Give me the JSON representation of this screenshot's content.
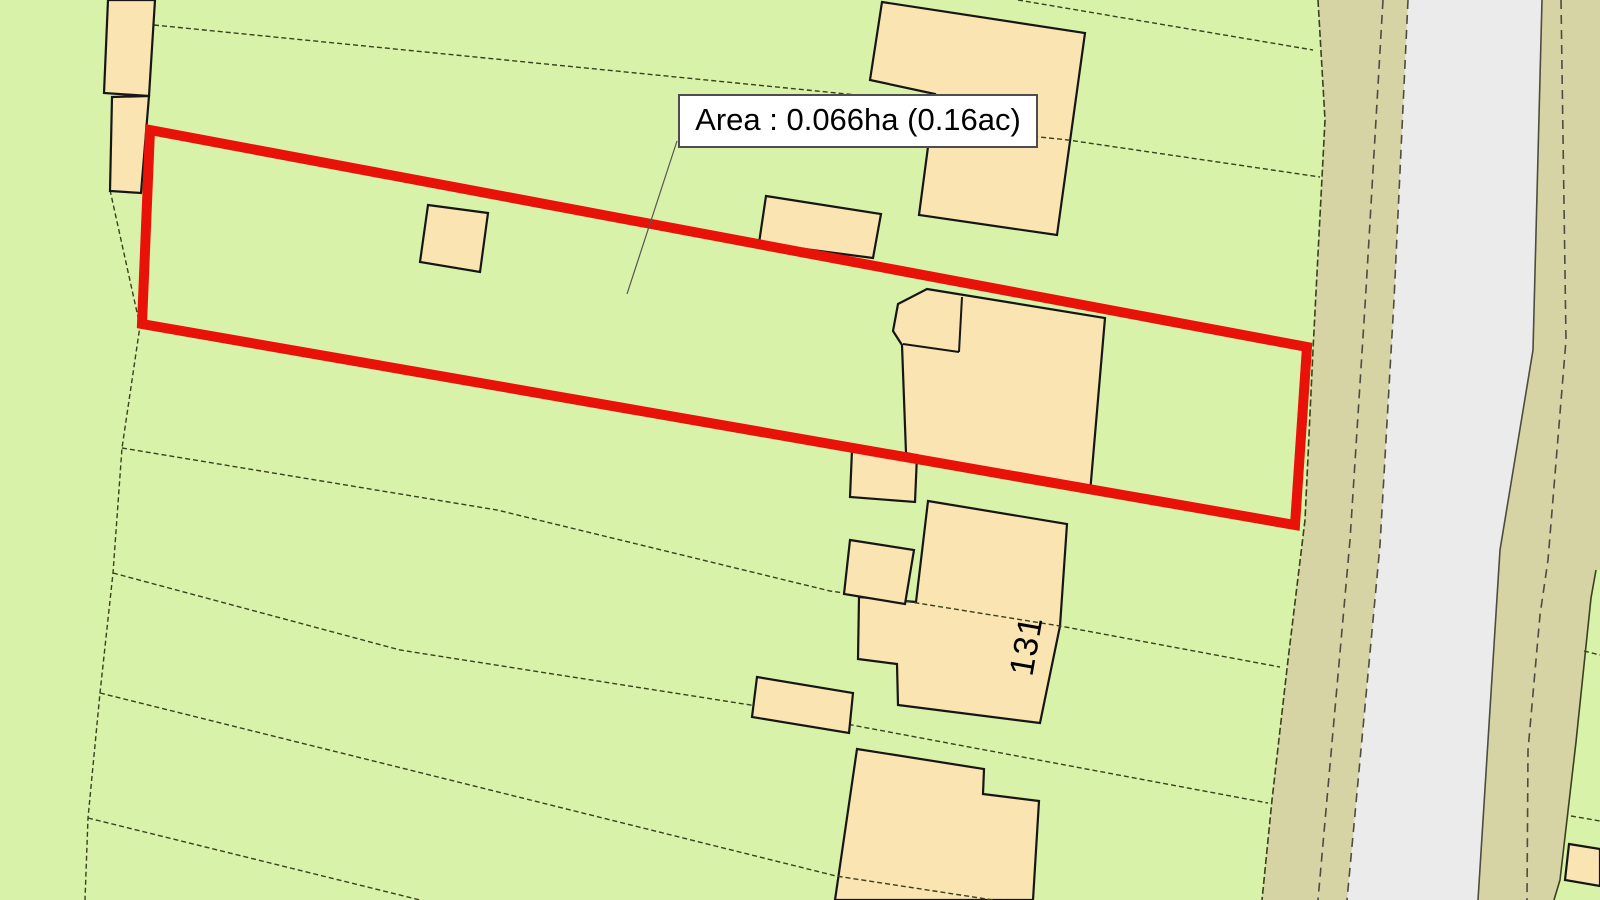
{
  "scene": {
    "width": 1600,
    "height": 900
  },
  "palette": {
    "parcel_green": "#d9f2a9",
    "building_fill": "#f9e4b2",
    "building_outline": "#161616",
    "verge_tan": "#d6d3a4",
    "road_grey": "#ebebeb",
    "boundary_line": "#39411f",
    "road_line": "#4c4c40",
    "plot_red": "#e81209",
    "leader_grey": "#555555",
    "label_border": "#4d4d4d",
    "label_bg": "#ffffff",
    "text_black": "#000000"
  },
  "area_label": {
    "text": "Area : 0.066ha (0.16ac)",
    "x": 678,
    "y": 94,
    "width": 360,
    "height": 54,
    "font_size": 31
  },
  "house_number": {
    "text": "131",
    "x": 1027,
    "y": 646,
    "rotation_deg": -80,
    "font_size": 34
  },
  "layers": [
    {
      "name": "ground-parcels",
      "kind": "polygon",
      "points": [
        [
          0,
          0
        ],
        [
          1600,
          0
        ],
        [
          1600,
          900
        ],
        [
          0,
          900
        ]
      ],
      "fill": "parcel_green",
      "interactable": false
    },
    {
      "name": "road-verge",
      "kind": "polygon",
      "points": [
        [
          1318,
          0
        ],
        [
          1600,
          0
        ],
        [
          1600,
          900
        ],
        [
          1262,
          900
        ],
        [
          1272,
          800
        ],
        [
          1288,
          660
        ],
        [
          1305,
          520
        ],
        [
          1313,
          350
        ],
        [
          1325,
          120
        ]
      ],
      "fill": "verge_tan",
      "interactable": false
    },
    {
      "name": "road-carriageway",
      "kind": "polygon",
      "points": [
        [
          1408,
          0
        ],
        [
          1542,
          0
        ],
        [
          1533,
          350
        ],
        [
          1500,
          550
        ],
        [
          1478,
          900
        ],
        [
          1347,
          900
        ],
        [
          1380,
          545
        ],
        [
          1394,
          300
        ]
      ],
      "fill": "road_grey",
      "interactable": false
    },
    {
      "name": "east-parcels",
      "kind": "polygon",
      "points": [
        [
          1596,
          570
        ],
        [
          1600,
          570
        ],
        [
          1600,
          900
        ],
        [
          1554,
          900
        ],
        [
          1560,
          880
        ],
        [
          1576,
          742
        ],
        [
          1591,
          598
        ]
      ],
      "fill": "parcel_green",
      "interactable": false
    },
    {
      "name": "verge-west-edge-line",
      "closed": false,
      "points": [
        [
          1318,
          0
        ],
        [
          1325,
          120
        ],
        [
          1313,
          350
        ],
        [
          1305,
          520
        ],
        [
          1288,
          660
        ],
        [
          1272,
          800
        ],
        [
          1262,
          900
        ]
      ],
      "stroke": "boundary_line",
      "width": 1.6,
      "dash": "7 3",
      "interactable": false
    },
    {
      "name": "verge-dash-line-west",
      "closed": false,
      "points": [
        [
          1383,
          0
        ],
        [
          1366,
          290
        ],
        [
          1350,
          540
        ],
        [
          1318,
          900
        ]
      ],
      "stroke": "road_line",
      "width": 1.6,
      "dash": "9 6",
      "interactable": false
    },
    {
      "name": "road-west-edge-line",
      "closed": false,
      "points": [
        [
          1408,
          0
        ],
        [
          1394,
          300
        ],
        [
          1380,
          545
        ],
        [
          1347,
          900
        ]
      ],
      "stroke": "road_line",
      "width": 1.6,
      "dash": "9 6",
      "interactable": false
    },
    {
      "name": "road-east-edge-line",
      "closed": false,
      "points": [
        [
          1542,
          0
        ],
        [
          1533,
          350
        ],
        [
          1500,
          550
        ],
        [
          1478,
          900
        ]
      ],
      "stroke": "road_line",
      "width": 1.6,
      "interactable": false
    },
    {
      "name": "verge-dash-line-east",
      "closed": false,
      "points": [
        [
          1561,
          0
        ],
        [
          1566,
          340
        ],
        [
          1548,
          560
        ],
        [
          1540,
          615
        ],
        [
          1528,
          750
        ],
        [
          1527,
          900
        ]
      ],
      "stroke": "road_line",
      "width": 1.6,
      "dash": "9 6",
      "interactable": false
    },
    {
      "name": "east-verge-edge-line",
      "closed": false,
      "points": [
        [
          1596,
          570
        ],
        [
          1591,
          598
        ],
        [
          1576,
          742
        ],
        [
          1560,
          880
        ],
        [
          1554,
          900
        ]
      ],
      "stroke": "boundary_line",
      "width": 1.6,
      "interactable": false
    },
    {
      "name": "building-north",
      "kind": "polygon",
      "points": [
        [
          882,
          2
        ],
        [
          1085,
          33
        ],
        [
          1057,
          235
        ],
        [
          919,
          215
        ],
        [
          935,
          94
        ],
        [
          870,
          80
        ]
      ],
      "fill": "building_fill",
      "stroke": "building_outline",
      "width": 2.2,
      "interactable": false
    },
    {
      "name": "building-131",
      "kind": "polygon",
      "points": [
        [
          928,
          501
        ],
        [
          1067,
          524
        ],
        [
          1060,
          626
        ],
        [
          1040,
          723
        ],
        [
          898,
          705
        ],
        [
          897,
          664
        ],
        [
          858,
          659
        ],
        [
          859,
          597
        ],
        [
          916,
          602
        ]
      ],
      "fill": "building_fill",
      "stroke": "building_outline",
      "width": 2.2,
      "interactable": false
    },
    {
      "name": "building-south",
      "kind": "polygon",
      "points": [
        [
          857,
          749
        ],
        [
          984,
          769
        ],
        [
          983,
          794
        ],
        [
          1039,
          801
        ],
        [
          1033,
          900
        ],
        [
          835,
          900
        ]
      ],
      "fill": "building_fill",
      "stroke": "building_outline",
      "width": 2.2,
      "interactable": false
    },
    {
      "name": "west-boundary-line",
      "closed": false,
      "points": [
        [
          110,
          190
        ],
        [
          140,
          326
        ],
        [
          122,
          448
        ],
        [
          113,
          573
        ],
        [
          100,
          693
        ],
        [
          88,
          818
        ],
        [
          85,
          900
        ]
      ],
      "stroke": "boundary_line",
      "width": 1.4,
      "dash": "5 3",
      "interactable": false
    },
    {
      "name": "parcel-line-north",
      "closed": false,
      "points": [
        [
          154,
          25
        ],
        [
          877,
          97
        ],
        [
          1002,
          133
        ],
        [
          1068,
          140
        ],
        [
          1320,
          177
        ]
      ],
      "stroke": "boundary_line",
      "width": 1.4,
      "dash": "5 3",
      "interactable": false
    },
    {
      "name": "parcel-line-top",
      "closed": false,
      "points": [
        [
          1018,
          0
        ],
        [
          1313,
          50
        ]
      ],
      "stroke": "boundary_line",
      "width": 1.4,
      "dash": "5 3",
      "interactable": false
    },
    {
      "name": "parcel-line-1",
      "closed": false,
      "points": [
        [
          122,
          448
        ],
        [
          497,
          510
        ],
        [
          830,
          591
        ],
        [
          917,
          603
        ],
        [
          1060,
          626
        ],
        [
          1280,
          667
        ]
      ],
      "stroke": "boundary_line",
      "width": 1.4,
      "dash": "5 3",
      "interactable": false
    },
    {
      "name": "parcel-line-2",
      "closed": false,
      "points": [
        [
          113,
          573
        ],
        [
          400,
          650
        ],
        [
          757,
          706
        ],
        [
          857,
          726
        ],
        [
          1268,
          803
        ]
      ],
      "stroke": "boundary_line",
      "width": 1.4,
      "dash": "5 3",
      "interactable": false
    },
    {
      "name": "parcel-line-3",
      "closed": false,
      "points": [
        [
          100,
          693
        ],
        [
          836,
          876
        ],
        [
          993,
          900
        ]
      ],
      "stroke": "boundary_line",
      "width": 1.4,
      "dash": "5 3",
      "interactable": false
    },
    {
      "name": "parcel-line-4",
      "closed": false,
      "points": [
        [
          88,
          818
        ],
        [
          420,
          900
        ]
      ],
      "stroke": "boundary_line",
      "width": 1.4,
      "dash": "5 3",
      "interactable": false
    },
    {
      "name": "east-parcel-line-1",
      "closed": false,
      "points": [
        [
          1584,
          651
        ],
        [
          1600,
          655
        ]
      ],
      "stroke": "boundary_line",
      "width": 1.4,
      "dash": "5 3",
      "interactable": false
    },
    {
      "name": "east-parcel-line-2",
      "closed": false,
      "points": [
        [
          1571,
          816
        ],
        [
          1600,
          821
        ]
      ],
      "stroke": "boundary_line",
      "width": 1.4,
      "dash": "5 3",
      "interactable": false
    },
    {
      "name": "outbuilding-nw-1",
      "kind": "polygon",
      "points": [
        [
          108,
          0
        ],
        [
          155,
          0
        ],
        [
          149,
          96
        ],
        [
          104,
          93
        ]
      ],
      "fill": "building_fill",
      "stroke": "building_outline",
      "width": 2.2,
      "interactable": false
    },
    {
      "name": "outbuilding-nw-2",
      "kind": "polygon",
      "points": [
        [
          112,
          97
        ],
        [
          149,
          96
        ],
        [
          141,
          193
        ],
        [
          110,
          191
        ]
      ],
      "fill": "building_fill",
      "stroke": "building_outline",
      "width": 2.2,
      "interactable": false
    },
    {
      "name": "shed-in-plot",
      "kind": "polygon",
      "points": [
        [
          428,
          205
        ],
        [
          488,
          213
        ],
        [
          480,
          272
        ],
        [
          420,
          262
        ]
      ],
      "fill": "building_fill",
      "stroke": "building_outline",
      "width": 2.2,
      "interactable": false
    },
    {
      "name": "outbuilding-mid",
      "kind": "polygon",
      "points": [
        [
          766,
          196
        ],
        [
          881,
          214
        ],
        [
          873,
          258
        ],
        [
          759,
          243
        ]
      ],
      "fill": "building_fill",
      "stroke": "building_outline",
      "width": 2.2,
      "interactable": false
    },
    {
      "name": "building-in-plot",
      "kind": "polygon",
      "points": [
        [
          927,
          289
        ],
        [
          1105,
          318
        ],
        [
          1090,
          493
        ],
        [
          906,
          453
        ],
        [
          902,
          345
        ],
        [
          893,
          331
        ],
        [
          898,
          304
        ]
      ],
      "fill": "building_fill",
      "stroke": "building_outline",
      "width": 2.2,
      "interactable": false
    },
    {
      "name": "building-in-plot-division-1",
      "closed": false,
      "points": [
        [
          962,
          297
        ],
        [
          959,
          352
        ]
      ],
      "stroke": "building_outline",
      "width": 2,
      "interactable": false
    },
    {
      "name": "building-in-plot-division-2",
      "closed": false,
      "points": [
        [
          903,
          344
        ],
        [
          959,
          352
        ]
      ],
      "stroke": "building_outline",
      "width": 2,
      "interactable": false
    },
    {
      "name": "shed-south-1",
      "kind": "polygon",
      "points": [
        [
          852,
          450
        ],
        [
          917,
          455
        ],
        [
          915,
          502
        ],
        [
          850,
          497
        ]
      ],
      "fill": "building_fill",
      "stroke": "building_outline",
      "width": 2.2,
      "interactable": false
    },
    {
      "name": "shed-south-2",
      "kind": "polygon",
      "points": [
        [
          850,
          540
        ],
        [
          914,
          550
        ],
        [
          905,
          604
        ],
        [
          844,
          594
        ]
      ],
      "fill": "building_fill",
      "stroke": "building_outline",
      "width": 2.2,
      "interactable": false
    },
    {
      "name": "shed-south-3",
      "kind": "polygon",
      "points": [
        [
          757,
          677
        ],
        [
          853,
          693
        ],
        [
          849,
          733
        ],
        [
          752,
          717
        ]
      ],
      "fill": "building_fill",
      "stroke": "building_outline",
      "width": 2.2,
      "interactable": false
    },
    {
      "name": "building-se",
      "kind": "polygon",
      "points": [
        [
          1569,
          844
        ],
        [
          1600,
          849
        ],
        [
          1600,
          886
        ],
        [
          1565,
          880
        ]
      ],
      "fill": "building_fill",
      "stroke": "building_outline",
      "width": 2.2,
      "interactable": false
    },
    {
      "name": "plot-boundary-base",
      "kind": "polygon",
      "points": [
        [
          150,
          133
        ],
        [
          1307,
          350
        ],
        [
          1295,
          528
        ],
        [
          142,
          327
        ]
      ],
      "stroke": "boundary_line",
      "width": 1.4,
      "dash": "5 3",
      "interactable": false
    },
    {
      "name": "plot-boundary-red",
      "kind": "polygon",
      "points": [
        [
          150,
          133
        ],
        [
          1307,
          350
        ],
        [
          1295,
          528
        ],
        [
          142,
          327
        ]
      ],
      "stroke": "plot_red",
      "width": 10,
      "dy": -3,
      "interactable": true
    },
    {
      "name": "label-leader-line",
      "closed": false,
      "points": [
        [
          677,
          141
        ],
        [
          627,
          294
        ]
      ],
      "stroke": "leader_grey",
      "width": 1.2,
      "interactable": false
    }
  ]
}
